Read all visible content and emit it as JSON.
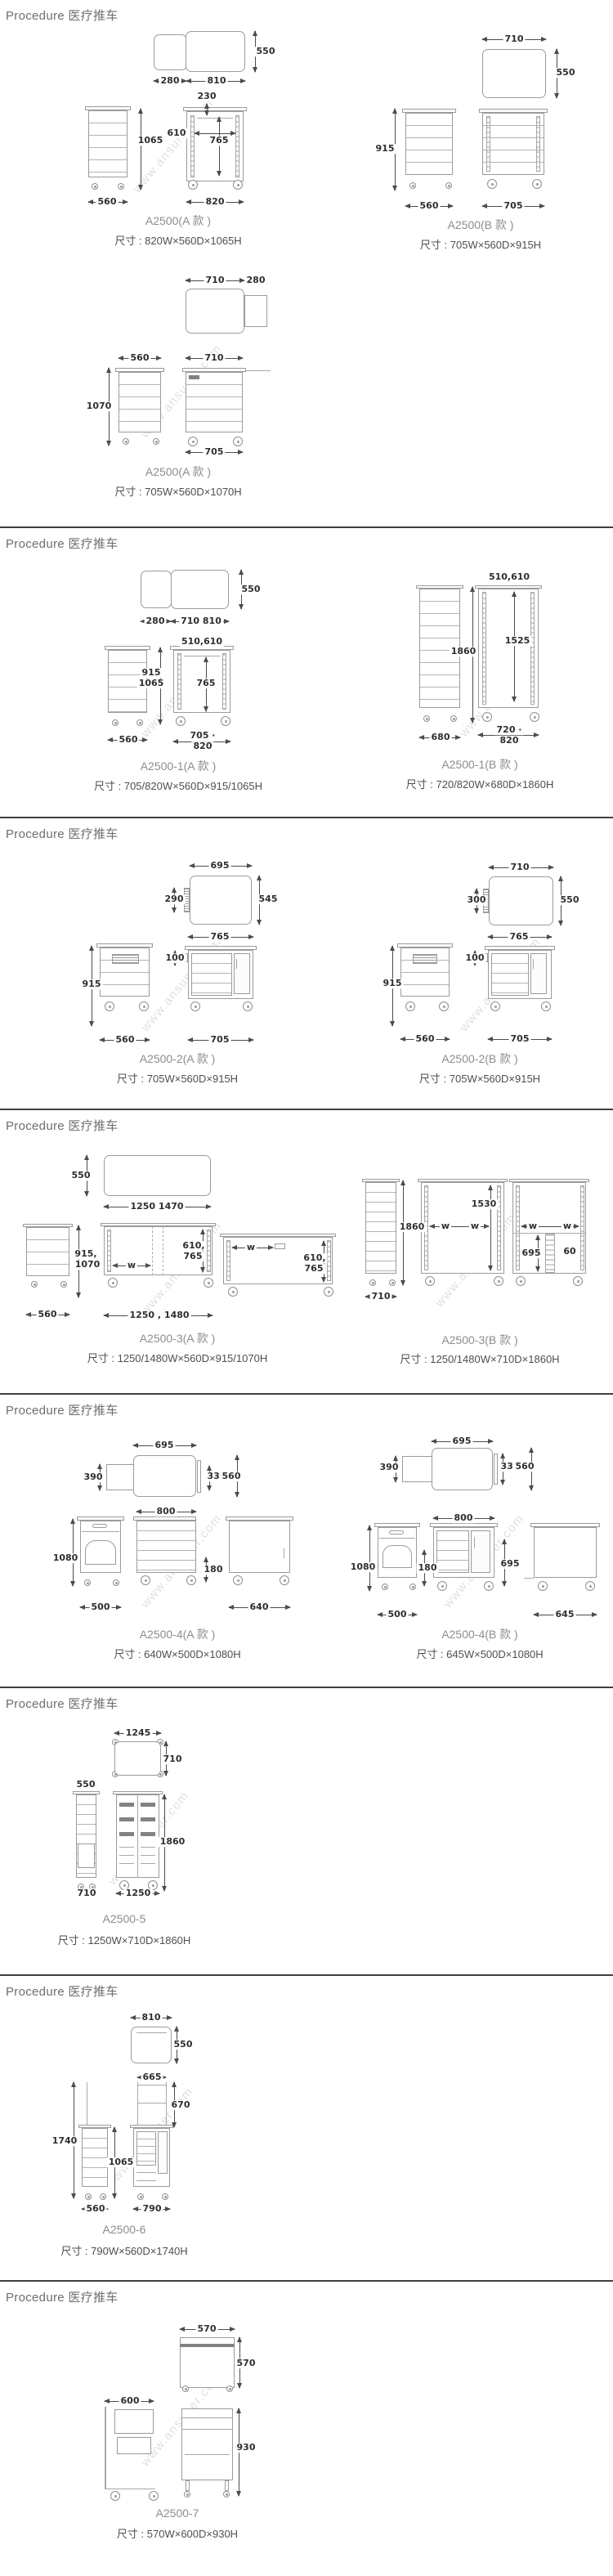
{
  "page": {
    "watermark": "www.ansuner.com"
  },
  "sections": [
    {
      "header": "Procedure 医疗推车",
      "products": [
        {
          "model": "A2500(A 款 )",
          "size": "尺寸 : 820W×560D×1065H",
          "dims": [
            "550",
            "280",
            "810",
            "230",
            "610",
            "765",
            "1065",
            "560",
            "820"
          ]
        },
        {
          "model": "A2500(B 款 )",
          "size": "尺寸 : 705W×560D×915H",
          "dims": [
            "710",
            "550",
            "915",
            "560",
            "705"
          ]
        },
        {
          "model": "A2500(A 款 )",
          "size": "尺寸 : 705W×560D×1070H",
          "dims": [
            "710",
            "280",
            "560",
            "710",
            "1070",
            "705"
          ]
        }
      ]
    },
    {
      "header": "Procedure 医疗推车",
      "products": [
        {
          "model": "A2500-1(A 款 )",
          "size": "尺寸 : 705/820W×560D×915/1065H",
          "dims": [
            "550",
            "280",
            "710 810",
            "510,610",
            "915",
            "1065",
            "765",
            "560",
            "705 ·",
            "820"
          ]
        },
        {
          "model": "A2500-1(B 款 )",
          "size": "尺寸 : 720/820W×680D×1860H",
          "dims": [
            "510,610",
            "1860",
            "1525",
            "680",
            "720 ·",
            "820"
          ]
        }
      ]
    },
    {
      "header": "Procedure 医疗推车",
      "products": [
        {
          "model": "A2500-2(A 款 )",
          "size": "尺寸 : 705W×560D×915H",
          "dims": [
            "695",
            "290",
            "545",
            "765",
            "100",
            "915",
            "560",
            "705"
          ]
        },
        {
          "model": "A2500-2(B 款 )",
          "size": "尺寸 : 705W×560D×915H",
          "dims": [
            "710",
            "300",
            "550",
            "765",
            "100",
            "915",
            "560",
            "705"
          ]
        }
      ]
    },
    {
      "header": "Procedure 医疗推车",
      "products": [
        {
          "model": "A2500-3(A 款 )",
          "size": "尺寸 : 1250/1480W×560D×915/1070H",
          "dims": [
            "550",
            "1250 1470",
            "915,",
            "1070",
            "560",
            "w",
            "610,",
            "765",
            "1250 , 1480",
            "w",
            "610,",
            "765"
          ]
        },
        {
          "model": "A2500-3(B 款 )",
          "size": "尺寸 : 1250/1480W×710D×1860H",
          "dims": [
            "1860",
            "710",
            "1530",
            "w",
            "w",
            "w",
            "w",
            "695",
            "60"
          ]
        }
      ]
    },
    {
      "header": "Procedure 医疗推车",
      "products": [
        {
          "model": "A2500-4(A 款 )",
          "size": "尺寸 : 640W×500D×1080H",
          "dims": [
            "695",
            "390",
            "330",
            "560",
            "800",
            "1080",
            "180",
            "500",
            "640"
          ]
        },
        {
          "model": "A2500-4(B 款 )",
          "size": "尺寸 : 645W×500D×1080H",
          "dims": [
            "695",
            "390",
            "330",
            "560",
            "800",
            "1080",
            "180",
            "695",
            "500",
            "645"
          ]
        }
      ]
    },
    {
      "header": "Procedure 医疗推车",
      "products": [
        {
          "model": "A2500-5",
          "size": "尺寸 : 1250W×710D×1860H",
          "dims": [
            "1245",
            "710",
            "550",
            "1860",
            "710",
            "1250"
          ]
        }
      ]
    },
    {
      "header": "Procedure 医疗推车",
      "products": [
        {
          "model": "A2500-6",
          "size": "尺寸 : 790W×560D×1740H",
          "dims": [
            "810",
            "550",
            "665",
            "670",
            "1740",
            "1065",
            "560",
            "790"
          ]
        }
      ]
    },
    {
      "header": "Procedure 医疗推车",
      "products": [
        {
          "model": "A2500-7",
          "size": "尺寸 : 570W×600D×930H",
          "dims": [
            "570",
            "570",
            "600",
            "930"
          ]
        }
      ]
    }
  ]
}
